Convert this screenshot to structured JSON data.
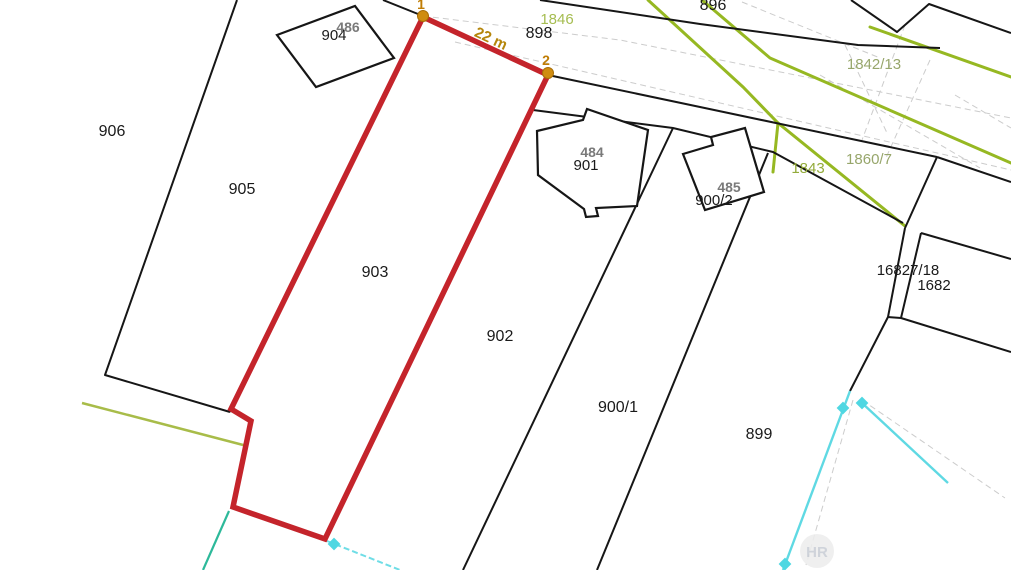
{
  "map": {
    "type": "cadastral-parcel-map",
    "colors": {
      "parcel_line": "#161616",
      "highlight_outline": "#c4242b",
      "vertex_marker": "#cf8c10",
      "measure_text": "#b5860b",
      "landuse_green": "#96b822",
      "landuse_olive": "#a8bc49",
      "new_state_cyan": "#5fd9e3",
      "new_state_teal": "#2db99a",
      "ghost_gray": "#cccccc",
      "building_number_gray": "#7a7a7a",
      "watermark_gray": "#c9ced6"
    },
    "measurement": {
      "label": "22 m",
      "from_point": "1",
      "to_point": "2"
    },
    "highlighted_parcel": "903",
    "labels": [
      {
        "id": "parcel-906",
        "text": "906",
        "x": 112,
        "y": 136,
        "size": 16,
        "fill": "#1a1a1a",
        "weight": "normal",
        "rotate": 0
      },
      {
        "id": "parcel-905",
        "text": "905",
        "x": 242,
        "y": 194,
        "size": 16,
        "fill": "#1a1a1a",
        "weight": "normal",
        "rotate": 0
      },
      {
        "id": "parcel-903",
        "text": "903",
        "x": 375,
        "y": 277,
        "size": 16,
        "fill": "#1a1a1a",
        "weight": "normal",
        "rotate": 0
      },
      {
        "id": "parcel-902",
        "text": "902",
        "x": 500,
        "y": 341,
        "size": 16,
        "fill": "#1a1a1a",
        "weight": "normal",
        "rotate": 0
      },
      {
        "id": "parcel-900-1",
        "text": "900/1",
        "x": 618,
        "y": 412,
        "size": 16,
        "fill": "#1a1a1a",
        "weight": "normal",
        "rotate": 0
      },
      {
        "id": "parcel-899",
        "text": "899",
        "x": 759,
        "y": 439,
        "size": 16,
        "fill": "#1a1a1a",
        "weight": "normal",
        "rotate": 0
      },
      {
        "id": "parcel-898",
        "text": "898",
        "x": 539,
        "y": 38,
        "size": 16,
        "fill": "#1a1a1a",
        "weight": "normal",
        "rotate": 0
      },
      {
        "id": "parcel-896",
        "text": "896",
        "x": 713,
        "y": 10,
        "size": 16,
        "fill": "#1a1a1a",
        "weight": "normal",
        "rotate": 0
      },
      {
        "id": "parcel-904",
        "text": "904",
        "x": 334,
        "y": 40,
        "size": 15,
        "fill": "#1a1a1a",
        "weight": "normal",
        "rotate": 0
      },
      {
        "id": "building-486",
        "text": "486",
        "x": 348,
        "y": 32,
        "size": 14,
        "fill": "#7a7a7a",
        "weight": "bold",
        "rotate": 0
      },
      {
        "id": "parcel-901",
        "text": "901",
        "x": 586,
        "y": 170,
        "size": 15,
        "fill": "#1a1a1a",
        "weight": "normal",
        "rotate": 0
      },
      {
        "id": "building-484",
        "text": "484",
        "x": 592,
        "y": 157,
        "size": 14,
        "fill": "#7a7a7a",
        "weight": "bold",
        "rotate": 0
      },
      {
        "id": "parcel-900-2",
        "text": "900/2",
        "x": 714,
        "y": 205,
        "size": 15,
        "fill": "#1a1a1a",
        "weight": "normal",
        "rotate": 0
      },
      {
        "id": "building-485",
        "text": "485",
        "x": 729,
        "y": 192,
        "size": 14,
        "fill": "#7a7a7a",
        "weight": "bold",
        "rotate": 0
      },
      {
        "id": "parcel-16827-18",
        "text": "16827/18",
        "x": 908,
        "y": 275,
        "size": 15,
        "fill": "#1a1a1a",
        "weight": "normal",
        "rotate": 0
      },
      {
        "id": "parcel-1682",
        "text": "1682",
        "x": 934,
        "y": 290,
        "size": 15,
        "fill": "#1a1a1a",
        "weight": "normal",
        "rotate": 0
      },
      {
        "id": "parcel-1846",
        "text": "1846",
        "x": 557,
        "y": 24,
        "size": 15,
        "fill": "#a6bd51",
        "weight": "normal",
        "rotate": 0
      },
      {
        "id": "parcel-1842-13",
        "text": "1842/13",
        "x": 874,
        "y": 69,
        "size": 15,
        "fill": "#97a66b",
        "weight": "normal",
        "rotate": 0
      },
      {
        "id": "parcel-1860-7",
        "text": "1860/7",
        "x": 869,
        "y": 164,
        "size": 15,
        "fill": "#97a66b",
        "weight": "normal",
        "rotate": 0
      },
      {
        "id": "parcel-1843",
        "text": "1843",
        "x": 808,
        "y": 173,
        "size": 15,
        "fill": "#93ab3a",
        "weight": "normal",
        "rotate": 0
      },
      {
        "id": "measure-22m",
        "text": "22 m",
        "x": 489,
        "y": 43,
        "size": 15,
        "fill": "#b5860b",
        "weight": "bold",
        "rotate": 25
      },
      {
        "id": "point-1",
        "text": "1",
        "x": 421,
        "y": 9,
        "size": 14,
        "fill": "#c07d05",
        "weight": "bold",
        "rotate": 0
      },
      {
        "id": "point-2",
        "text": "2",
        "x": 546,
        "y": 65,
        "size": 14,
        "fill": "#c07d05",
        "weight": "bold",
        "rotate": 0
      }
    ],
    "watermark": {
      "text": "HR"
    }
  }
}
